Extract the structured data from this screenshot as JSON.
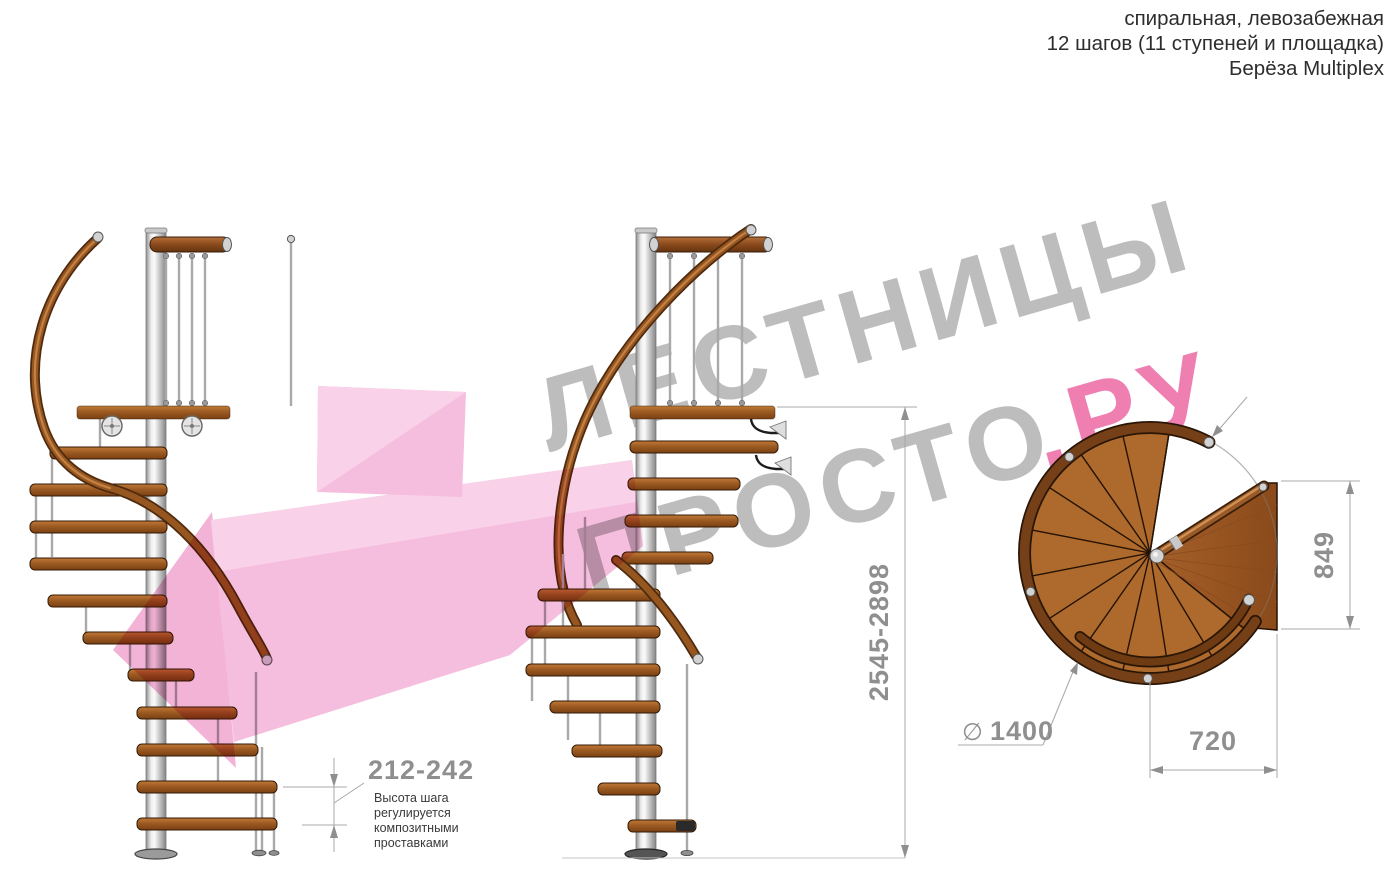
{
  "title_block": {
    "line1": "спиральная, левозабежная",
    "line2": "12 шагов (11 ступеней и площадка)",
    "line3": "Берёза Multiplex"
  },
  "watermark": {
    "word1": "ЛЕСТНИЦЫ",
    "word2": "ПРОСТО",
    "word2_suffix": ".РУ",
    "color_gray": "#b0b0b0",
    "color_pink": "#ec64a2"
  },
  "drawing": {
    "dimensions": {
      "step_height": {
        "value": "212-242",
        "note": [
          "Высота шага",
          "регулируется",
          "композитными",
          "проставками"
        ]
      },
      "total_height": {
        "value": "2545-2898"
      },
      "exit_width": {
        "value": "849"
      },
      "platform_depth": {
        "value": "720"
      },
      "diameter": {
        "symbol": "∅",
        "value": "1400"
      }
    },
    "colors": {
      "wood": "#ad6a2c",
      "wood_dark": "#754017",
      "metal": "#d6d6d6",
      "dimension_gray": "#8f8f8f",
      "pink_overlay": "#f4aed6"
    }
  }
}
